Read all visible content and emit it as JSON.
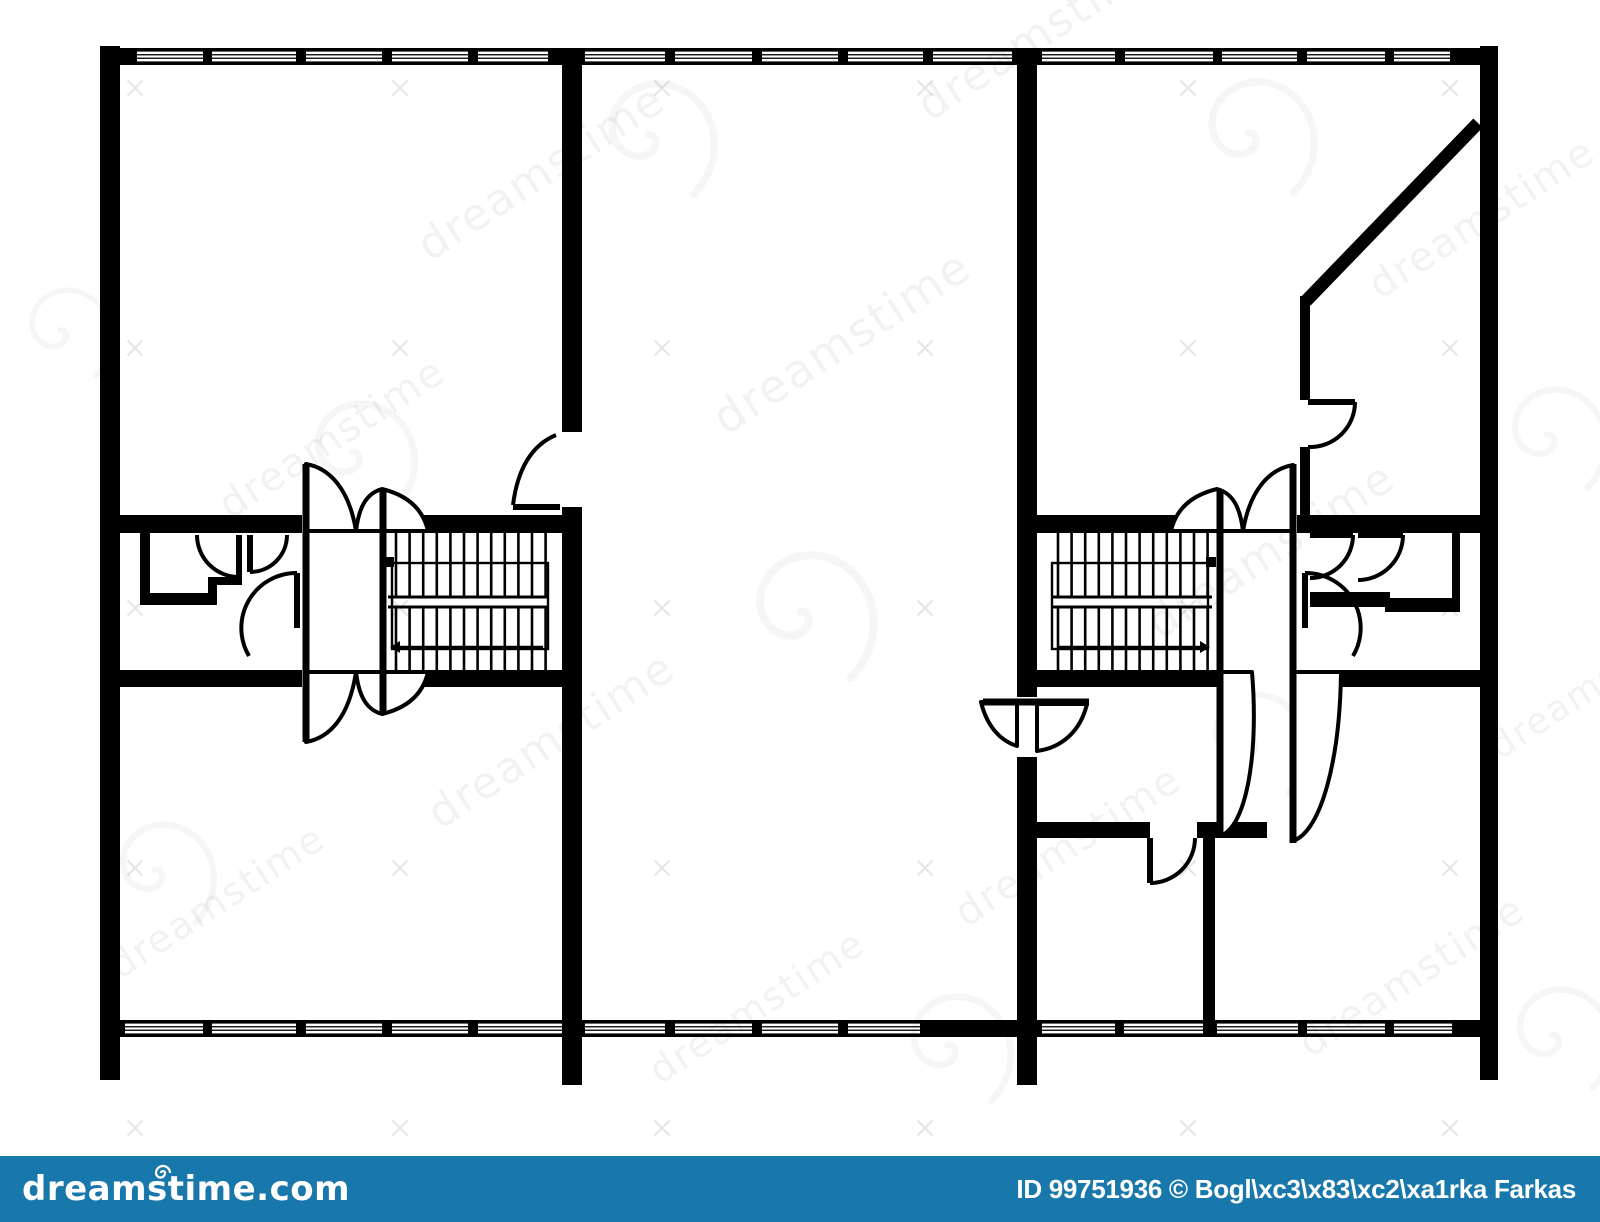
{
  "page": {
    "background": "#ffffff",
    "ink": "#000000"
  },
  "footer": {
    "brand": "dreamstime.com",
    "credit": "ID 99751936 © Bogl\\xc3\\x83\\xc2\\xa1rka Farkas",
    "bar_color": "#1878ab",
    "text_color": "#ffffff"
  },
  "watermark": {
    "text": "dreamstime",
    "text_opacity": 0.05,
    "texts": [
      [
        430,
        262,
        44
      ],
      [
        930,
        122,
        44
      ],
      [
        1380,
        300,
        40
      ],
      [
        230,
        520,
        40
      ],
      [
        726,
        436,
        46
      ],
      [
        1160,
        640,
        44
      ],
      [
        440,
        830,
        44
      ],
      [
        966,
        928,
        40
      ],
      [
        1310,
        1058,
        40
      ],
      [
        120,
        980,
        38
      ],
      [
        1500,
        760,
        36
      ],
      [
        660,
        1085,
        38
      ]
    ],
    "spirals": [
      [
        648,
        135,
        0.9
      ],
      [
        1248,
        133,
        0.9
      ],
      [
        352,
        452,
        0.85
      ],
      [
        800,
        612,
        1.0
      ],
      [
        1248,
        740,
        0.8
      ],
      [
        948,
        1045,
        0.85
      ],
      [
        1552,
        1035,
        0.8
      ],
      [
        1547,
        435,
        0.8
      ],
      [
        155,
        870,
        0.8
      ],
      [
        60,
        330,
        0.7
      ]
    ],
    "crosses": {
      "xs": [
        135,
        400,
        662,
        925,
        1188,
        1450
      ],
      "ys": [
        88,
        348,
        608,
        868,
        1128
      ],
      "size": 15,
      "opacity": 0.1
    }
  },
  "plan": {
    "walls": [
      [
        100,
        46,
        20,
        1034
      ],
      [
        1480,
        46,
        18,
        1034
      ],
      [
        562,
        65,
        20,
        367
      ],
      [
        562,
        507,
        20,
        578
      ],
      [
        1017,
        65,
        20,
        632
      ],
      [
        1017,
        757,
        20,
        328
      ],
      [
        120,
        515,
        182,
        18
      ],
      [
        387,
        515,
        175,
        18
      ],
      [
        120,
        670,
        182,
        17
      ],
      [
        387,
        670,
        175,
        17
      ],
      [
        1037,
        515,
        180,
        18
      ],
      [
        1297,
        515,
        183,
        18
      ],
      [
        1037,
        670,
        183,
        17
      ],
      [
        1297,
        670,
        183,
        17
      ],
      [
        140,
        533,
        10,
        72
      ],
      [
        140,
        593,
        68,
        12
      ],
      [
        208,
        577,
        9,
        28
      ],
      [
        217,
        577,
        25,
        8
      ],
      [
        1310,
        592,
        80,
        15
      ],
      [
        1385,
        598,
        75,
        14
      ],
      [
        1452,
        533,
        8,
        74
      ],
      [
        1037,
        822,
        113,
        16
      ],
      [
        1197,
        822,
        70,
        16
      ],
      [
        1203,
        838,
        12,
        182
      ],
      [
        1300,
        296,
        10,
        104
      ],
      [
        1300,
        447,
        10,
        70
      ]
    ],
    "diagonals": [
      [
        1478,
        123,
        1306,
        301,
        13
      ]
    ],
    "window_bands": [
      {
        "y": 48,
        "h": 17,
        "segments": [
          [
            "s",
            100,
            137
          ],
          [
            "g",
            137,
            203
          ],
          [
            "s",
            203,
            212
          ],
          [
            "g",
            212,
            296
          ],
          [
            "s",
            296,
            306
          ],
          [
            "g",
            306,
            382
          ],
          [
            "s",
            382,
            392
          ],
          [
            "g",
            392,
            468
          ],
          [
            "s",
            468,
            478
          ],
          [
            "g",
            478,
            548
          ],
          [
            "s",
            548,
            585
          ],
          [
            "g",
            585,
            665
          ],
          [
            "s",
            665,
            675
          ],
          [
            "g",
            675,
            752
          ],
          [
            "s",
            752,
            762
          ],
          [
            "g",
            762,
            838
          ],
          [
            "s",
            838,
            848
          ],
          [
            "g",
            848,
            923
          ],
          [
            "s",
            923,
            933
          ],
          [
            "g",
            933,
            1012
          ],
          [
            "s",
            1012,
            1042
          ],
          [
            "g",
            1042,
            1115
          ],
          [
            "s",
            1115,
            1125
          ],
          [
            "g",
            1125,
            1213
          ],
          [
            "s",
            1213,
            1222
          ],
          [
            "g",
            1222,
            1297
          ],
          [
            "s",
            1297,
            1307
          ],
          [
            "g",
            1307,
            1385
          ],
          [
            "s",
            1385,
            1394
          ],
          [
            "g",
            1394,
            1450
          ],
          [
            "s",
            1450,
            1498
          ]
        ]
      },
      {
        "y": 1020,
        "h": 17,
        "segments": [
          [
            "s",
            100,
            125
          ],
          [
            "g",
            125,
            203
          ],
          [
            "s",
            203,
            212
          ],
          [
            "g",
            212,
            296
          ],
          [
            "s",
            296,
            306
          ],
          [
            "g",
            306,
            382
          ],
          [
            "s",
            382,
            392
          ],
          [
            "g",
            392,
            468
          ],
          [
            "s",
            468,
            478
          ],
          [
            "g",
            478,
            562
          ],
          [
            "s",
            562,
            585
          ],
          [
            "g",
            585,
            665
          ],
          [
            "s",
            665,
            675
          ],
          [
            "g",
            675,
            752
          ],
          [
            "s",
            752,
            762
          ],
          [
            "g",
            762,
            838
          ],
          [
            "s",
            838,
            848
          ],
          [
            "g",
            848,
            920
          ],
          [
            "s",
            920,
            1042
          ],
          [
            "g",
            1042,
            1115
          ],
          [
            "s",
            1115,
            1124
          ],
          [
            "g",
            1124,
            1203
          ],
          [
            "s",
            1203,
            1217
          ],
          [
            "g",
            1217,
            1298
          ],
          [
            "s",
            1298,
            1307
          ],
          [
            "g",
            1307,
            1385
          ],
          [
            "s",
            1385,
            1394
          ],
          [
            "g",
            1394,
            1452
          ],
          [
            "s",
            1452,
            1498
          ]
        ]
      }
    ],
    "stairs": [
      {
        "name": "staircase-left",
        "treads": {
          "from": 396,
          "to": 546,
          "step": 13.6,
          "top": [
            533,
            597
          ],
          "bot": [
            607,
            670
          ]
        },
        "mid": [
          388,
          548
        ],
        "midY": [
          597,
          607
        ],
        "rail": [
          392,
          563,
          156,
          86
        ],
        "square": [
          384,
          557,
          10
        ],
        "arrow": {
          "y": 647,
          "x1": 543,
          "x2": 400,
          "dir": -1
        }
      },
      {
        "name": "staircase-right",
        "treads": {
          "from": 1058,
          "to": 1208,
          "step": 13.6,
          "top": [
            533,
            597
          ],
          "bot": [
            607,
            670
          ]
        },
        "mid": [
          1052,
          1212
        ],
        "midY": [
          597,
          607
        ],
        "rail": [
          1052,
          563,
          156,
          86
        ],
        "square": [
          1206,
          557,
          10
        ],
        "arrow": {
          "y": 647,
          "x1": 1057,
          "x2": 1200,
          "dir": 1
        }
      }
    ],
    "doors": [
      {
        "name": "vestibule-left-door-1",
        "leaf": [
          239,
          535,
          239,
          577
        ],
        "arc": "M197,535 A42 42 0 0 0 239,577"
      },
      {
        "name": "vestibule-left-door-2",
        "leaf": [
          250,
          535,
          250,
          572
        ],
        "arc": "M250,572 A37 37 0 0 0 287,535"
      },
      {
        "name": "vestibule-left-door-3",
        "leaf": [
          297,
          573,
          297,
          628
        ],
        "arc": "M297,573 A55 55 0 0 0 249,656"
      },
      {
        "name": "vestibule-right-door-1",
        "leaf": [
          1310,
          535,
          1353,
          535
        ],
        "arc": "M1353,535 A43 43 0 0 1 1310,578"
      },
      {
        "name": "vestibule-right-door-2",
        "leaf": [
          1358,
          535,
          1403,
          535
        ],
        "arc": "M1403,535 A45 45 0 0 1 1358,580"
      },
      {
        "name": "vestibule-right-door-3",
        "leaf": [
          1305,
          573,
          1305,
          628
        ],
        "arc": "M1305,573 A55 55 0 0 1 1353,656"
      },
      {
        "name": "unit-divider-left-door",
        "leaf": [
          513,
          507,
          560,
          507
        ],
        "arc": "M513,505 Q520,450 556,435"
      },
      {
        "name": "interior-room-door-right",
        "leaf": [
          1150,
          838,
          1150,
          883
        ],
        "arc": "M1150,883 A45 45 0 0 0 1195,838"
      },
      {
        "name": "diagonal-room-door",
        "leaf": [
          1308,
          402,
          1355,
          402
        ],
        "arc": "M1355,402 A45 45 0 0 1 1308,447"
      }
    ],
    "flowers": [
      {
        "name": "double-swing-door-left",
        "leaves": [
          [
            306,
            464,
            306,
            742
          ],
          [
            383,
            489,
            383,
            715
          ]
        ],
        "petals": [
          "M306,531 L306,464 C329,468 349,488 356,531 Z",
          "M356,531 C359,506 367,493 382,489 C407,495 423,509 428,531 Z",
          "M306,672 L306,742 C329,738 349,718 356,672 Z",
          "M356,672 C359,697 367,710 382,714 C407,708 423,694 428,672 Z"
        ]
      },
      {
        "name": "double-swing-door-right",
        "leaves": [
          [
            1220,
            489,
            1220,
            838
          ],
          [
            1293,
            464,
            1293,
            843
          ]
        ],
        "petals": [
          "M1293,531 L1293,465 C1270,469 1250,489 1243,531 Z",
          "M1243,531 C1240,506 1232,493 1217,489 C1192,495 1176,509 1171,531 Z",
          "M1220,672 L1220,836 C1246,828 1259,755 1252,672 Z",
          "M1293,672 L1293,841 C1322,831 1340,757 1341,672 Z"
        ]
      },
      {
        "name": "swing-door-unit-divider-right",
        "leaves": [
          [
            983,
            702,
            1089,
            702
          ]
        ],
        "petals": [
          "M1037,704 L1087,704 C1080,733 1060,748 1037,751 Z",
          "M1017,702 L981,702 C987,727 1001,741 1017,746 Z"
        ]
      }
    ]
  }
}
